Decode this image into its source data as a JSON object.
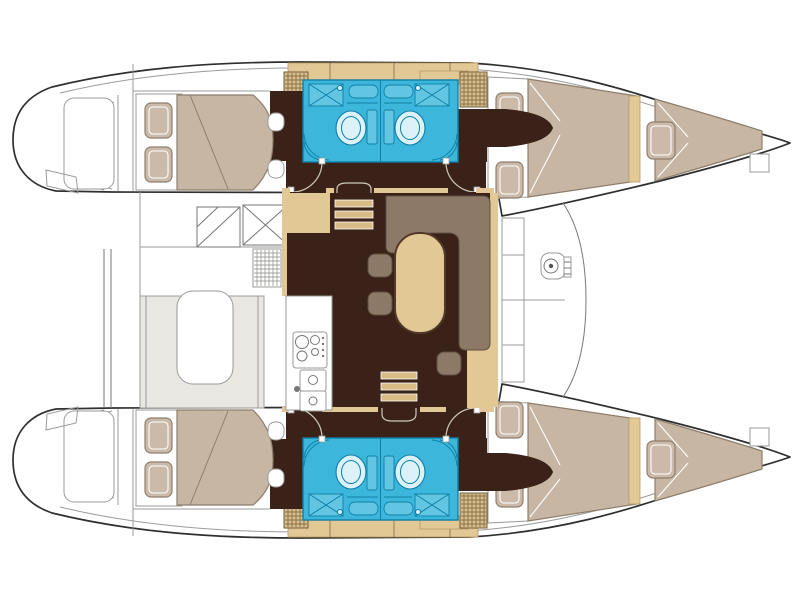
{
  "meta": {
    "diagram_type": "boat-floor-plan",
    "vessel": "sailing-catamaran",
    "view": "top-down-deck-plan",
    "orientation": "bow-right-stern-left"
  },
  "colors": {
    "paper": "#FFFFFF",
    "hull-line": "#2F2F2F",
    "deck-line": "#9A9A9A",
    "floor-dark": "#3B2218",
    "wood-tan": "#E2C894",
    "wood-tan-deep": "#D9BC85",
    "locker-tan": "#D9BE8C",
    "locker-grid": "#6F5C38",
    "bed-duvet": "#C7B6A4",
    "bed-pillow": "#CBBAA9",
    "bed-edge": "#8F7E6C",
    "upholstery": "#8C7968",
    "uph-edge": "#5F4F42",
    "bath-cyan": "#3CB7DB",
    "bath-line": "#0E7FA8",
    "bath-fixture": "#DCF2F9",
    "bath-counter": "#62C6E2",
    "cockpit-bench": "#E9E7E2"
  },
  "regions": [
    "aft-cabin-double-berth-port",
    "aft-cabin-double-berth-starboard",
    "forward-cabin-double-berth-port",
    "forward-cabin-double-berth-starboard",
    "forepeak-berth-port",
    "forepeak-berth-starboard",
    "bathroom-aft-port",
    "bathroom-forward-port",
    "bathroom-aft-starboard",
    "bathroom-forward-starboard",
    "saloon-with-u-settee-and-table",
    "galley-with-stove-and-double-sink",
    "cockpit-with-table-and-bench",
    "helm-seat-and-steps",
    "transom-steps-port",
    "transom-steps-starboard",
    "foredeck-with-windlass"
  ],
  "counts": {
    "cabins": 4,
    "bathrooms": 4,
    "forepeak_berths": 2,
    "toilets": 4,
    "companionway_steps": 2
  }
}
